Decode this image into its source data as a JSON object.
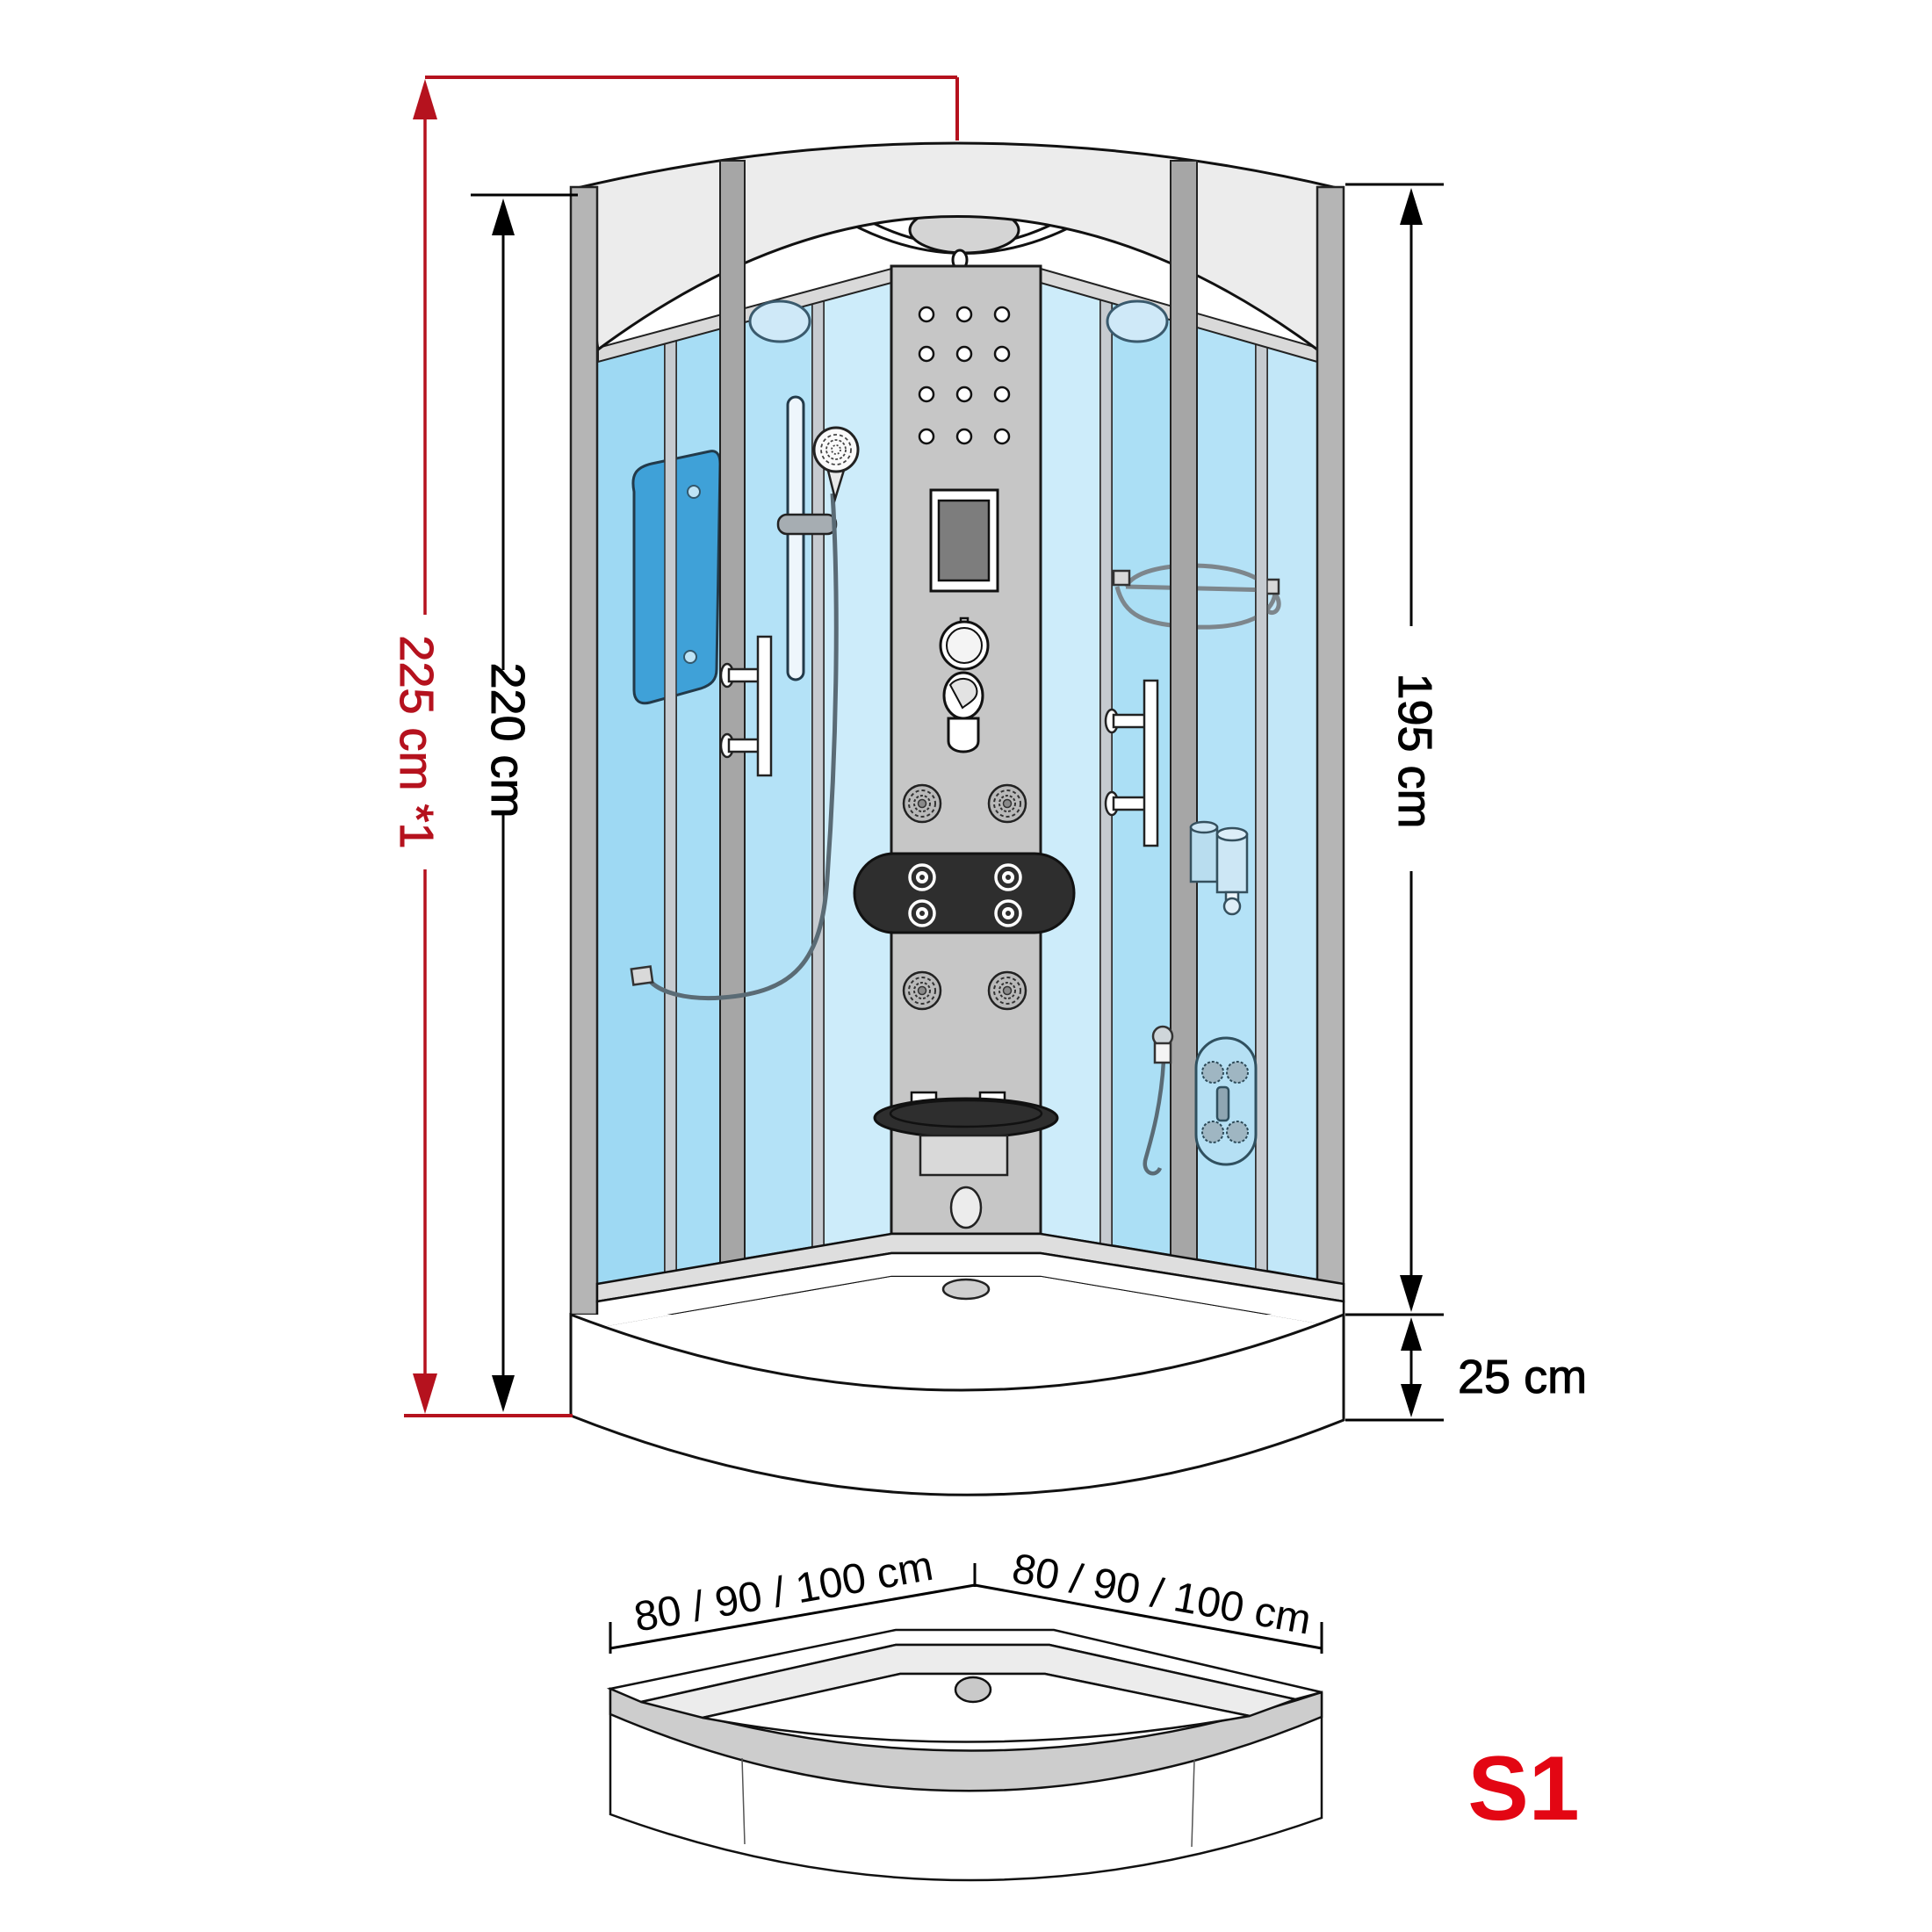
{
  "diagram": {
    "type": "shower-cabin-dimension-drawing",
    "model_code": "S1",
    "dimensions": {
      "total_height_note": "225 cm *1",
      "cabin_height": "220 cm",
      "glass_height": "195 cm",
      "tray_height": "25 cm",
      "tray_width_left": "80 / 90 / 100 cm",
      "tray_width_right": "80 / 90 / 100 cm"
    },
    "colors": {
      "dimension_red": "#b5121e",
      "dimension_black": "#000000",
      "model_red": "#e30613",
      "glass_blue": "#a8def5",
      "frame_gray": "#b5b5b5",
      "panel_gray": "#c6c6c6",
      "canopy_gray": "#ececec"
    },
    "parts": [
      "canopy",
      "ceiling-dome-light",
      "steam-nozzle",
      "glass-panels",
      "control-column",
      "massage-jets",
      "display-screen",
      "control-knob",
      "mixer-tap",
      "headrest",
      "hand-shower",
      "shower-rail",
      "glass-shelf",
      "towel-bar",
      "wire-rack",
      "soap-dispenser",
      "jet-panel",
      "fold-seat",
      "shower-tray",
      "drain"
    ]
  }
}
